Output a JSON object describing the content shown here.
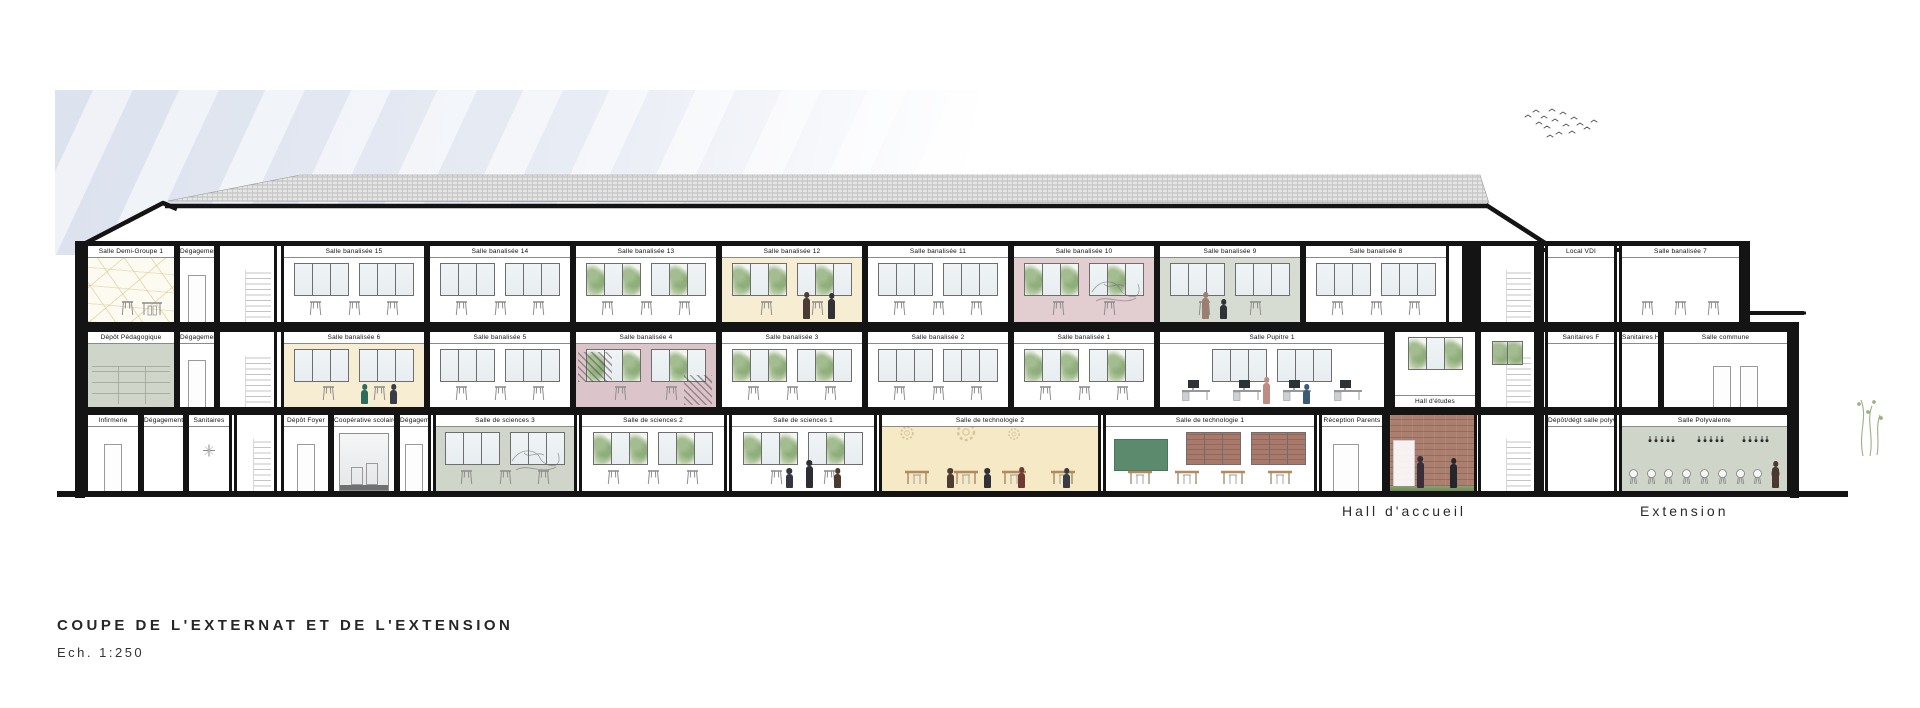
{
  "title_block": {
    "title": "COUPE DE L'EXTERNAT ET DE L'EXTENSION",
    "scale": "Ech. 1:250"
  },
  "site_labels": {
    "hall": "Hall d'accueil",
    "extension": "Extension"
  },
  "colors": {
    "ink": "#141414",
    "cream": "#f7edd2",
    "cream2": "#f5e9c6",
    "pink": "#e2cdd1",
    "pink2": "#dcc5ca",
    "sage": "#d7dcd3",
    "sage2": "#cfd5c9",
    "brick": "#a87a6c",
    "board": "#5c8a6d",
    "sky": "#dee4ef"
  },
  "floors": [
    {
      "level": "R+2",
      "y": 246,
      "h": 76,
      "rooms": [
        {
          "label": "Salle Demi-Groupe 1",
          "x": 85,
          "w": 92,
          "fx": {
            "web": 1,
            "table": 1
          }
        },
        {
          "label": "Dégagement R+2",
          "x": 177,
          "w": 40,
          "fx": {
            "door": 1
          }
        },
        {
          "x": 217,
          "w": 60,
          "name": "stairwell",
          "fx": {
            "stairs": 1
          }
        },
        {
          "label": "Salle banalisée 15",
          "x": 281,
          "w": 146,
          "fx": {
            "win": 2,
            "stools": 3
          }
        },
        {
          "label": "Salle banalisée 14",
          "x": 427,
          "w": 146,
          "fx": {
            "win": 2,
            "stools": 3
          }
        },
        {
          "label": "Salle banalisée 13",
          "x": 573,
          "w": 146,
          "fx": {
            "win": 2,
            "tree": 1,
            "stools": 3
          }
        },
        {
          "label": "Salle banalisée 12",
          "x": 719,
          "w": 146,
          "bg": "cream",
          "fx": {
            "win": 2,
            "tree": 1,
            "stools": 2,
            "people": [
              [
                58,
                21,
                "#4a3c35",
                0
              ],
              [
                76,
                20,
                "#2f3237",
                0
              ]
            ]
          }
        },
        {
          "label": "Salle banalisée 11",
          "x": 865,
          "w": 146,
          "fx": {
            "win": 2,
            "stools": 3
          }
        },
        {
          "label": "Salle banalisée 10",
          "x": 1011,
          "w": 146,
          "bg": "pink",
          "fx": {
            "win": 2,
            "tree": 1,
            "stools": 2,
            "scribble": 1
          }
        },
        {
          "label": "Salle banalisée 9",
          "x": 1157,
          "w": 146,
          "bg": "sage",
          "fx": {
            "win": 2,
            "stools": 2,
            "people": [
              [
                30,
                21,
                "#9b7d72",
                0
              ],
              [
                43,
                14,
                "#303239",
                1
              ]
            ]
          }
        },
        {
          "label": "Salle banalisée 8",
          "x": 1303,
          "w": 146,
          "fx": {
            "win": 2,
            "stools": 3
          }
        },
        {
          "x": 1478,
          "w": 59,
          "name": "stairwell",
          "fx": {
            "stairs": 1
          }
        },
        {
          "label": "Local VDI",
          "x": 1545,
          "w": 72,
          "fx": {}
        },
        {
          "label": "Salle banalisée 7",
          "x": 1619,
          "w": 123,
          "fx": {
            "stools": 3
          }
        }
      ]
    },
    {
      "level": "R+1",
      "y": 332,
      "h": 75,
      "rooms": [
        {
          "label": "Dépôt Pédagogique",
          "x": 85,
          "w": 92,
          "bg": "sage2",
          "fx": {
            "shelves": 1
          }
        },
        {
          "label": "Dégagement R+1",
          "x": 177,
          "w": 40,
          "fx": {
            "door": 1
          }
        },
        {
          "x": 217,
          "w": 60,
          "name": "stairwell",
          "fx": {
            "stairs": 1
          }
        },
        {
          "label": "Salle banalisée 6",
          "x": 281,
          "w": 146,
          "bg": "cream",
          "fx": {
            "win": 2,
            "stools": 2,
            "people": [
              [
                55,
                14,
                "#2e6b5a",
                1
              ],
              [
                76,
                14,
                "#3a3d46",
                1
              ]
            ]
          }
        },
        {
          "label": "Salle banalisée 5",
          "x": 427,
          "w": 146,
          "fx": {
            "win": 2,
            "stools": 3
          }
        },
        {
          "label": "Salle banalisée 4",
          "x": 573,
          "w": 146,
          "bg": "pink2",
          "fx": {
            "win": 2,
            "tree": 1,
            "hatch": 1,
            "stools": 2
          }
        },
        {
          "label": "Salle banalisée 3",
          "x": 719,
          "w": 146,
          "fx": {
            "win": 2,
            "tree": 1,
            "stools": 3
          }
        },
        {
          "label": "Salle banalisée 2",
          "x": 865,
          "w": 146,
          "fx": {
            "win": 2,
            "stools": 3
          }
        },
        {
          "label": "Salle banalisée 1",
          "x": 1011,
          "w": 146,
          "fx": {
            "win": 2,
            "tree": 1,
            "stools": 3
          }
        },
        {
          "label": "Salle Pupitre 1",
          "x": 1157,
          "w": 230,
          "fx": {
            "win": 2,
            "pcdesks": 4,
            "people": [
              [
                46,
                21,
                "#c08b81",
                0
              ],
              [
                64,
                14,
                "#3c5a76",
                1
              ]
            ]
          }
        },
        {
          "label": "Hall d'études",
          "x": 1392,
          "w": 86,
          "labelBottom": 1,
          "fx": {
            "win": 1,
            "tree": 1
          }
        },
        {
          "x": 1478,
          "w": 59,
          "name": "stairwell",
          "fx": {
            "stairs": 1,
            "greenpane": 1
          }
        },
        {
          "label": "Sanitaires F",
          "x": 1545,
          "w": 72,
          "fx": {}
        },
        {
          "label": "Sanitaires H",
          "x": 1619,
          "w": 42,
          "fx": {}
        },
        {
          "label": "Salle commune",
          "x": 1661,
          "w": 129,
          "fx": {
            "doors2": 1
          }
        }
      ]
    },
    {
      "level": "RDC",
      "y": 415,
      "h": 76,
      "rooms": [
        {
          "label": "Infirmerie",
          "x": 85,
          "w": 56,
          "fx": {
            "door": 1
          }
        },
        {
          "label": "Dégagement",
          "x": 141,
          "w": 45,
          "fx": {}
        },
        {
          "label": "Sanitaires",
          "x": 186,
          "w": 46,
          "fx": {
            "fan": 1
          }
        },
        {
          "x": 234,
          "w": 43,
          "name": "stairwell",
          "fx": {
            "stairs": 1
          }
        },
        {
          "label": "Dépôt Foyer",
          "x": 281,
          "w": 50,
          "fx": {
            "door": 1
          }
        },
        {
          "label": "Coopérative scolaire",
          "x": 331,
          "w": 66,
          "fx": {
            "glass": 1
          }
        },
        {
          "label": "Dégagement",
          "x": 397,
          "w": 34,
          "fx": {
            "door": 1
          }
        },
        {
          "label": "Salle de sciences 3",
          "x": 433,
          "w": 144,
          "bg": "sage2",
          "fx": {
            "win": 2,
            "stools": 3,
            "scribble": 1
          }
        },
        {
          "label": "Salle de sciences 2",
          "x": 579,
          "w": 148,
          "fx": {
            "win": 2,
            "tree": 1,
            "stools": 3
          }
        },
        {
          "label": "Salle de sciences 1",
          "x": 729,
          "w": 148,
          "fx": {
            "win": 2,
            "tree": 1,
            "stools": 2,
            "people": [
              [
                38,
                14,
                "#33363e",
                1
              ],
              [
                52,
                22,
                "#2c2e34",
                0
              ],
              [
                72,
                14,
                "#49392f",
                1
              ]
            ]
          }
        },
        {
          "label": "Salle de technologie 2",
          "x": 879,
          "w": 222,
          "bg": "cream2",
          "fx": {
            "gears": 1,
            "bdesks": 4,
            "people": [
              [
                30,
                14,
                "#4c3c32",
                1
              ],
              [
                47,
                14,
                "#303238",
                1
              ],
              [
                63,
                15,
                "#6e3a31",
                1
              ],
              [
                84,
                14,
                "#3a3c44",
                1
              ]
            ]
          }
        },
        {
          "label": "Salle de technologie 1",
          "x": 1103,
          "w": 214,
          "fx": {
            "board": 1,
            "brickwin": 2,
            "bdesks": 4
          }
        },
        {
          "label": "Réception Parents",
          "x": 1319,
          "w": 66,
          "fx": {
            "doorwide": 1
          }
        },
        {
          "x": 1387,
          "w": 90,
          "name": "hall-accueil-space",
          "brick": 1,
          "fx": {
            "grass": 1,
            "doorwhite": 1,
            "people": [
              [
                32,
                26,
                "#3a2f38",
                0
              ],
              [
                72,
                24,
                "#24262c",
                0
              ]
            ]
          }
        },
        {
          "x": 1478,
          "w": 59,
          "name": "stairwell",
          "fx": {
            "stairs": 1
          }
        },
        {
          "label": "Dépôt/dégt salle polyvalente",
          "x": 1545,
          "w": 72,
          "fx": {}
        },
        {
          "label": "Salle Polyvalente",
          "x": 1619,
          "w": 171,
          "bg": "sage2",
          "fx": {
            "chairs": 9,
            "lights": 1,
            "people": [
              [
                91,
                21,
                "#4a3831",
                0
              ]
            ]
          }
        }
      ]
    }
  ],
  "structure": {
    "slabs": [
      {
        "x": 80,
        "y": 241,
        "w": 1662,
        "h": 5
      },
      {
        "x": 80,
        "y": 322,
        "w": 1719,
        "h": 10
      },
      {
        "x": 80,
        "y": 407,
        "w": 1719,
        "h": 8
      },
      {
        "x": 1742,
        "y": 311,
        "w": 62,
        "h": 4
      }
    ],
    "walls": [
      {
        "x": 75,
        "y": 241,
        "w": 10,
        "h": 257
      },
      {
        "x": 1536,
        "y": 246,
        "w": 8,
        "h": 245
      },
      {
        "x": 1462,
        "y": 246,
        "w": 16,
        "h": 76
      },
      {
        "x": 1742,
        "y": 241,
        "w": 8,
        "h": 81
      },
      {
        "x": 1790,
        "y": 322,
        "w": 9,
        "h": 176
      },
      {
        "x": 1385,
        "y": 332,
        "w": 7,
        "h": 159
      }
    ]
  }
}
